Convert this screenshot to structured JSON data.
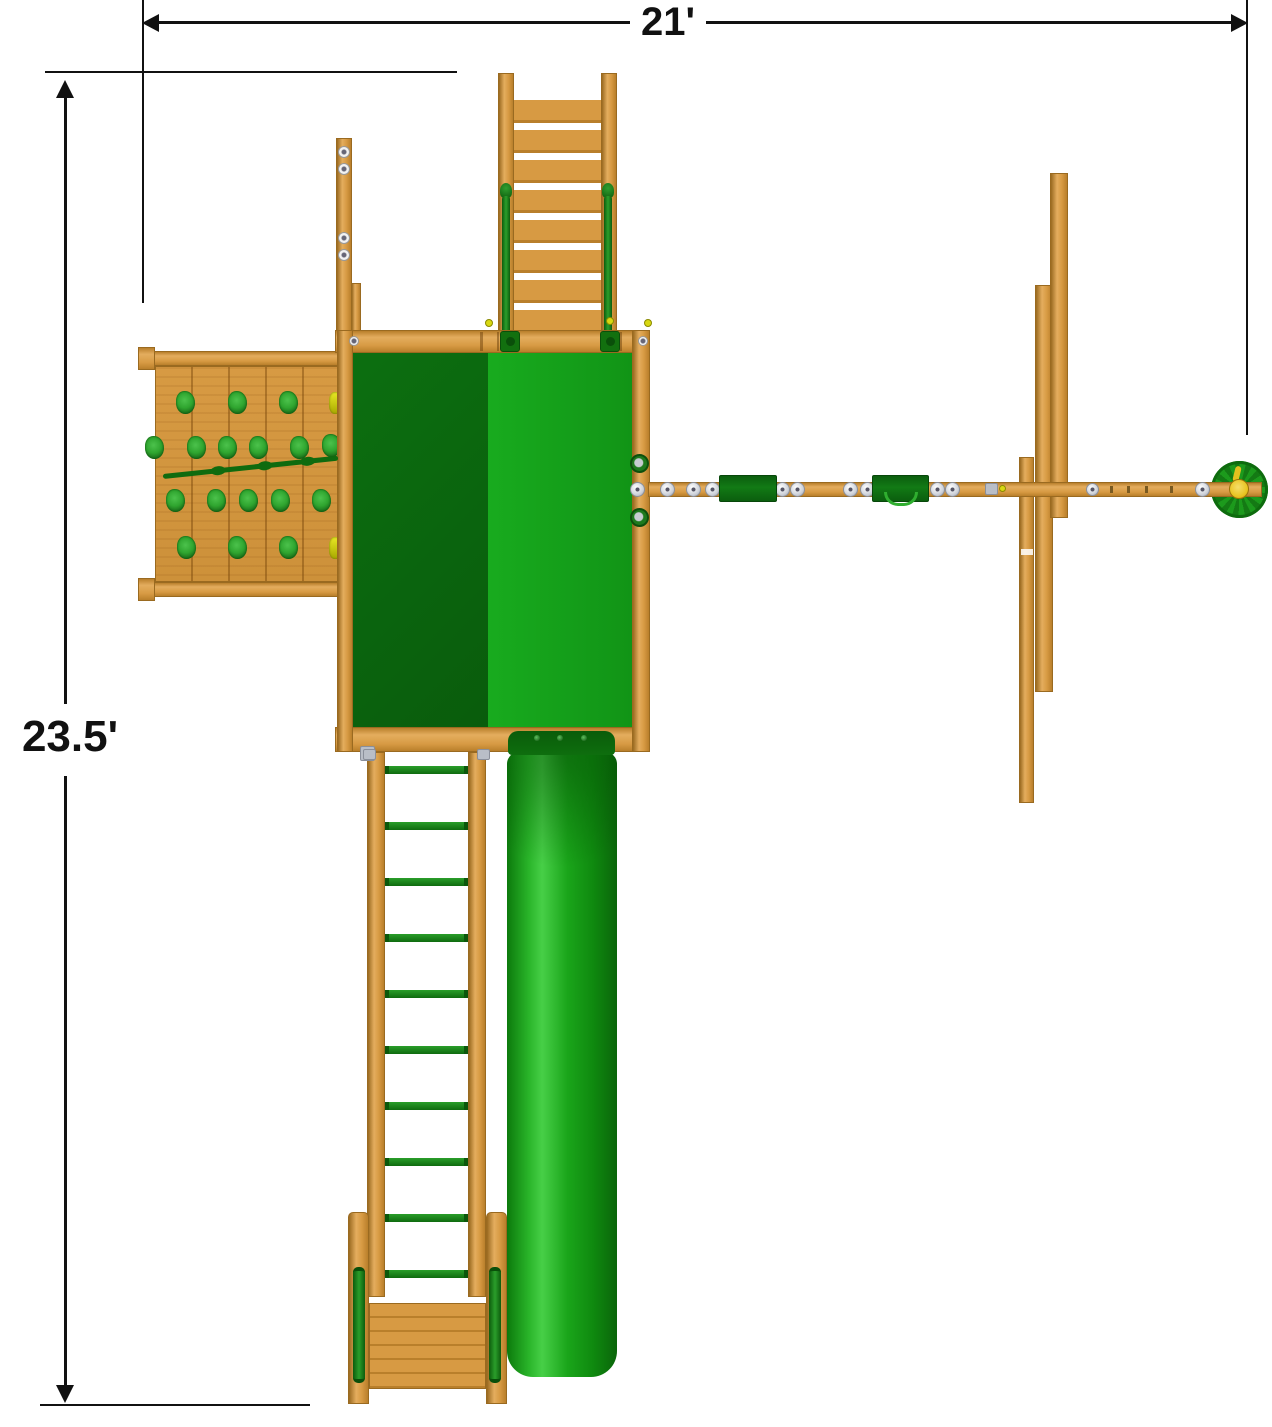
{
  "diagram": {
    "type": "playset-top-view-dimension-diagram",
    "dimensions": {
      "width_label": "21'",
      "height_label": "23.5'"
    },
    "components": [
      "width-dimension",
      "height-dimension",
      "access-ladder",
      "deck-canopy",
      "rock-climbing-wall",
      "climbing-rope",
      "swing-beam",
      "swing-seat-1",
      "swing-seat-2",
      "tire-swing",
      "a-frame-posts",
      "tube-slide",
      "monkey-bar-ladder",
      "bottom-access-steps"
    ]
  },
  "colors": {
    "wood": "#d79a43",
    "wood_dark": "#b97f2b",
    "wood_light": "#e4ad5e",
    "wood_edge": "#9a6a20",
    "canopy_dark": "#0a650e",
    "canopy_bright": "#14a01a",
    "slide_green": "#14a01a",
    "accent_green": "#1d8a1d",
    "hold_green": "#2fa52f",
    "hold_yellow": "#d8d812",
    "hardware_silver": "#cfd3da",
    "swivel_yellow": "#e9c31f",
    "line_black": "#111111"
  }
}
